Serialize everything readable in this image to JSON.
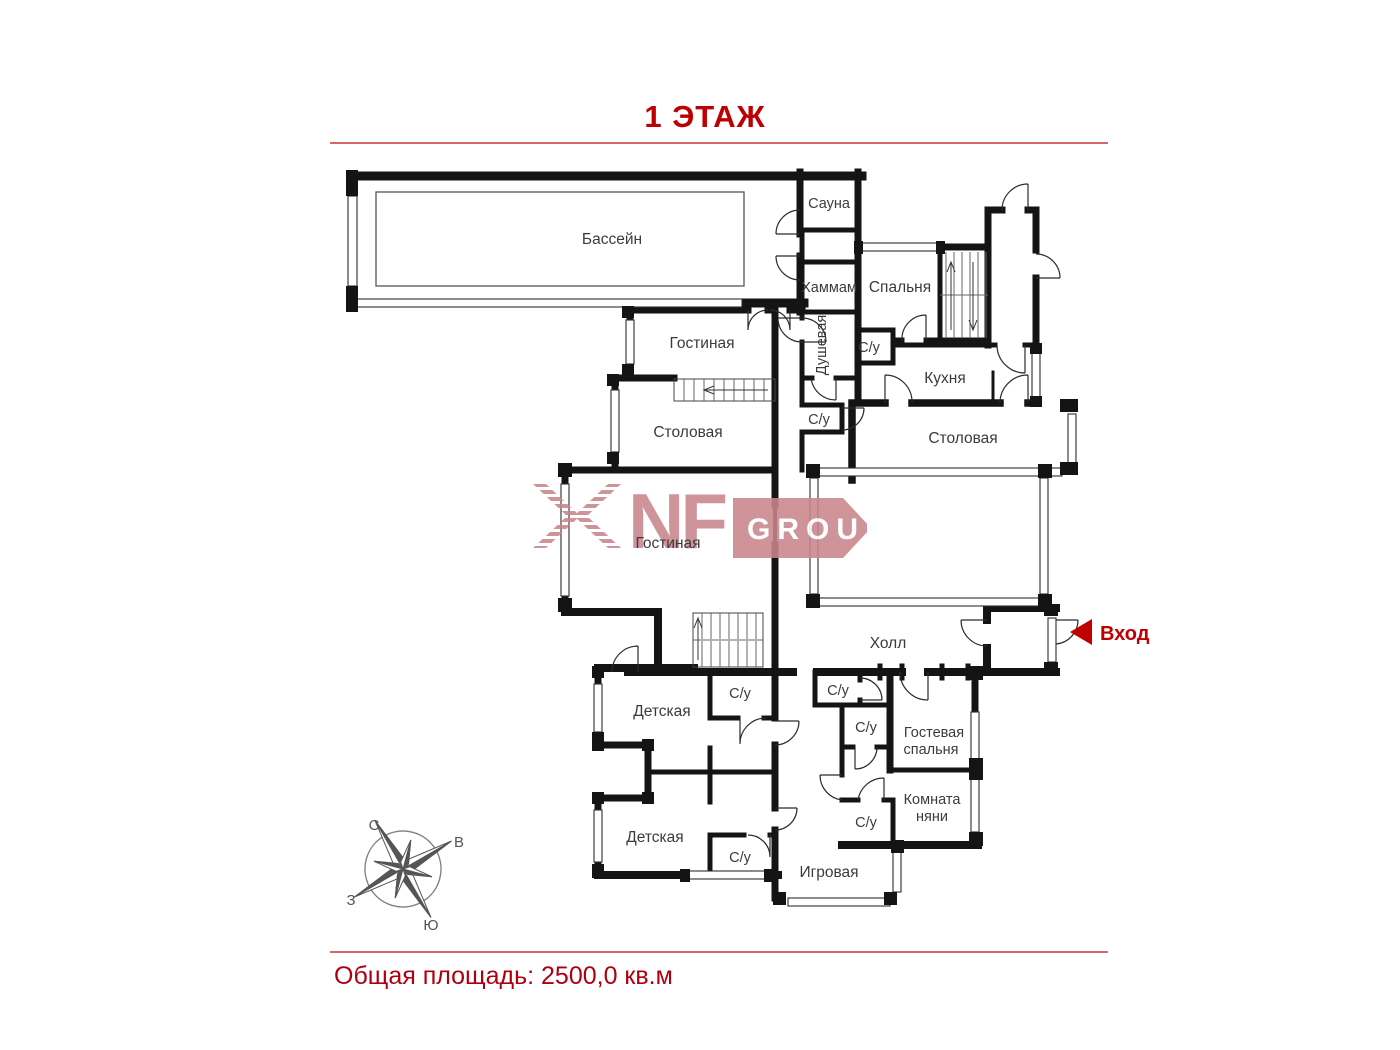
{
  "title": "1 ЭТАЖ",
  "footer": {
    "total_area": "Общая площадь: 2500,0 кв.м"
  },
  "logo": {
    "name": "NF GROUP watermark",
    "nf": "NF",
    "group": "GROUP"
  },
  "entrance": {
    "label": "Вход"
  },
  "compass": {
    "north": "С",
    "east": "В",
    "west": "З",
    "south": "Ю"
  },
  "colors": {
    "accent_red": "#c00000",
    "separator_red": "#c63535",
    "wall_black": "#141414",
    "logo_pink": "#c9868d",
    "label_gray": "#3b3b3b"
  },
  "rooms": [
    {
      "label": "Бассейн"
    },
    {
      "label": "Сауна"
    },
    {
      "label": "Хаммам"
    },
    {
      "label": "Спальня"
    },
    {
      "label": "С/у"
    },
    {
      "label": "Кухня"
    },
    {
      "label": "Столовая"
    },
    {
      "label": "Гостиная"
    },
    {
      "label": "Столовая"
    },
    {
      "label": "Душевая"
    },
    {
      "label": "С/у"
    },
    {
      "label": "Гостиная"
    },
    {
      "label": "Холл"
    },
    {
      "label": "Детская"
    },
    {
      "label": "С/у"
    },
    {
      "label": "Детская"
    },
    {
      "label": "С/у"
    },
    {
      "label": "С/у"
    },
    {
      "label": "С/у"
    },
    {
      "lines": [
        "Гостевая",
        "спальня"
      ]
    },
    {
      "lines": [
        "Комната",
        "няни"
      ]
    },
    {
      "label": "С/у"
    },
    {
      "label": "Игровая"
    }
  ]
}
